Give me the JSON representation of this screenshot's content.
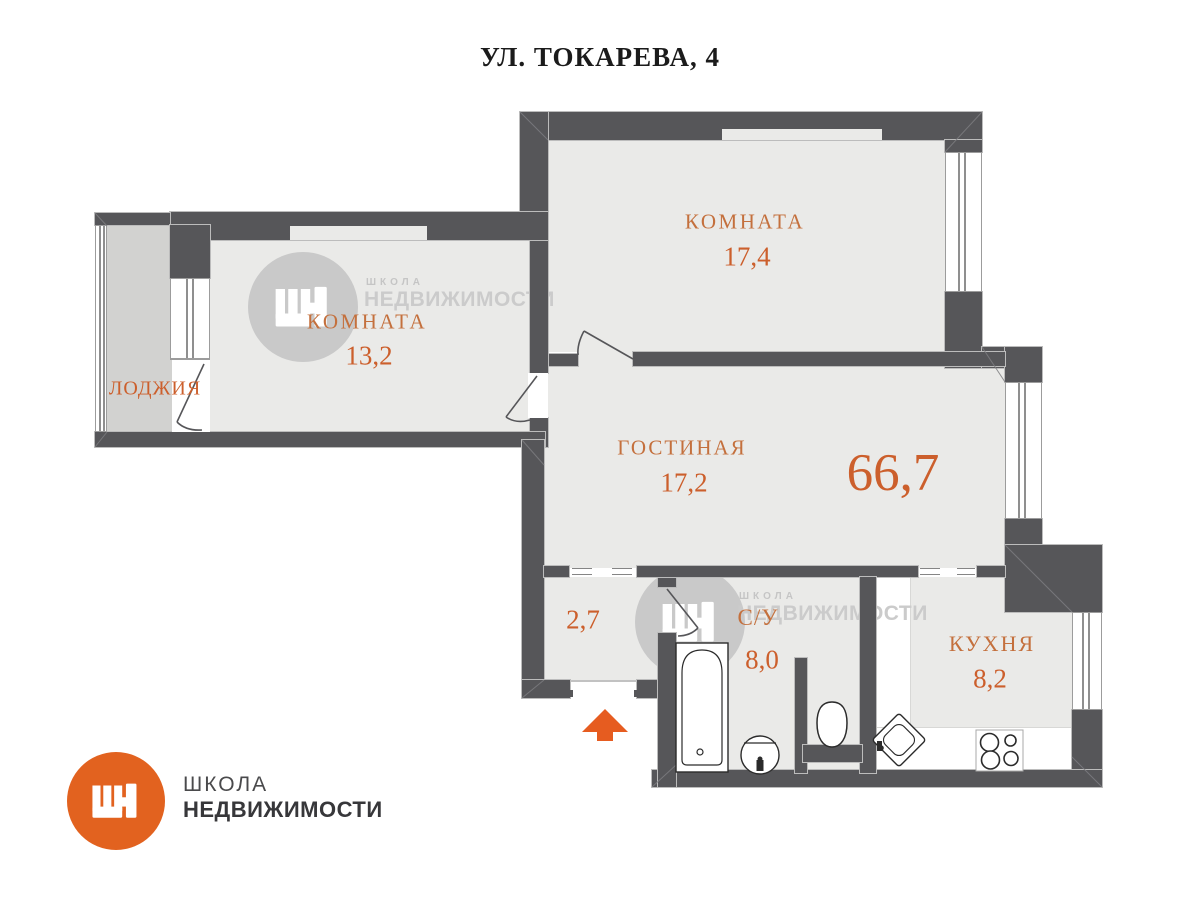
{
  "title": "УЛ. ТОКАРЕВА, 4",
  "rooms": {
    "bedroom1": {
      "name": "КОМНАТА",
      "area": "17,4"
    },
    "bedroom2": {
      "name": "КОМНАТА",
      "area": "13,2"
    },
    "loggia": {
      "name": "ЛОДЖИЯ"
    },
    "living": {
      "name": "ГОСТИНАЯ",
      "area": "17,2"
    },
    "hall": {
      "area": "2,7"
    },
    "bathroom": {
      "name": "С/У",
      "area": "8,0"
    },
    "kitchen": {
      "name": "КУХНЯ",
      "area": "8,2"
    }
  },
  "total_area": "66,7",
  "branding": {
    "monogram": "ШН",
    "school": "ШКОЛА",
    "realty": "НЕДВИЖИМОСТИ"
  },
  "watermark": {
    "school": "ШКОЛА",
    "realty": "НЕДВИЖИМОСТИ"
  },
  "colors": {
    "wall": "#565659",
    "floor": "#eaeae8",
    "loggia-floor": "#d2d2d0",
    "label-name": "#c4703d",
    "label-number": "#cc5f2c",
    "logo-orange": "#e2621f",
    "arrow-orange": "#e65c20",
    "watermark-gray": "#c9c9c9"
  }
}
